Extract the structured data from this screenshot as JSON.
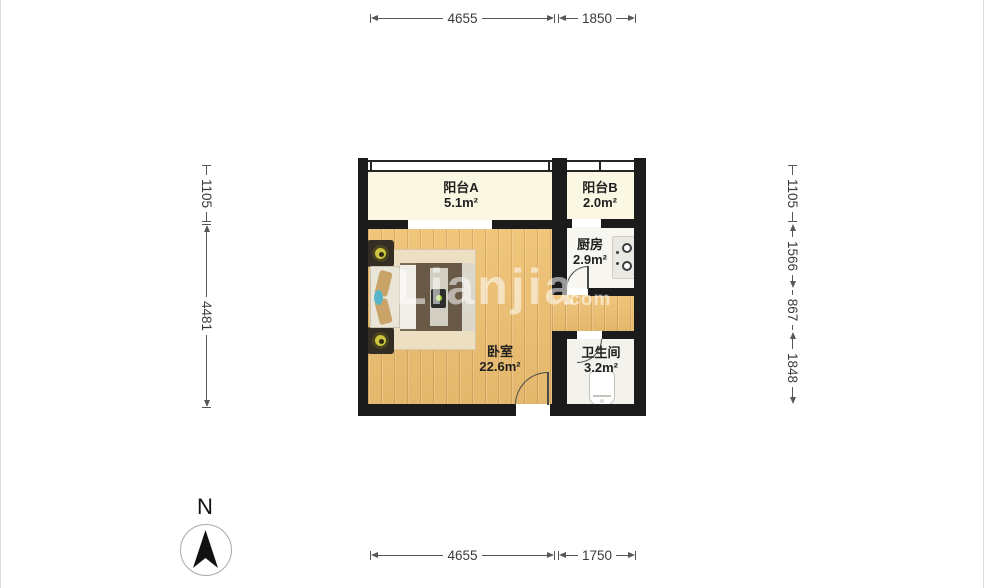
{
  "watermark": {
    "text": "Lianjia",
    "suffix": ".com"
  },
  "compass": {
    "label": "N"
  },
  "rooms": [
    {
      "id": "balcony-a",
      "name": "阳台A",
      "area": "5.1m²"
    },
    {
      "id": "balcony-b",
      "name": "阳台B",
      "area": "2.0m²"
    },
    {
      "id": "kitchen",
      "name": "厨房",
      "area": "2.9m²"
    },
    {
      "id": "bedroom",
      "name": "卧室",
      "area": "22.6m²"
    },
    {
      "id": "bathroom",
      "name": "卫生间",
      "area": "3.2m²"
    }
  ],
  "dimensions": {
    "top": [
      "4655",
      "1850"
    ],
    "bottom": [
      "4655",
      "1750"
    ],
    "left": [
      "1105",
      "4481"
    ],
    "right": [
      "1105",
      "1566",
      "867",
      "1848"
    ]
  },
  "colors": {
    "wall": "#1b1b1b",
    "wood_floor": "#efc172",
    "balcony_floor": "#faf8e3",
    "kitchen_floor": "#f7f6f0",
    "bathroom_floor": "#f3f2ec",
    "dimension_line": "#585858",
    "lamp": "#cdc63e",
    "blanket": "#685a47"
  }
}
